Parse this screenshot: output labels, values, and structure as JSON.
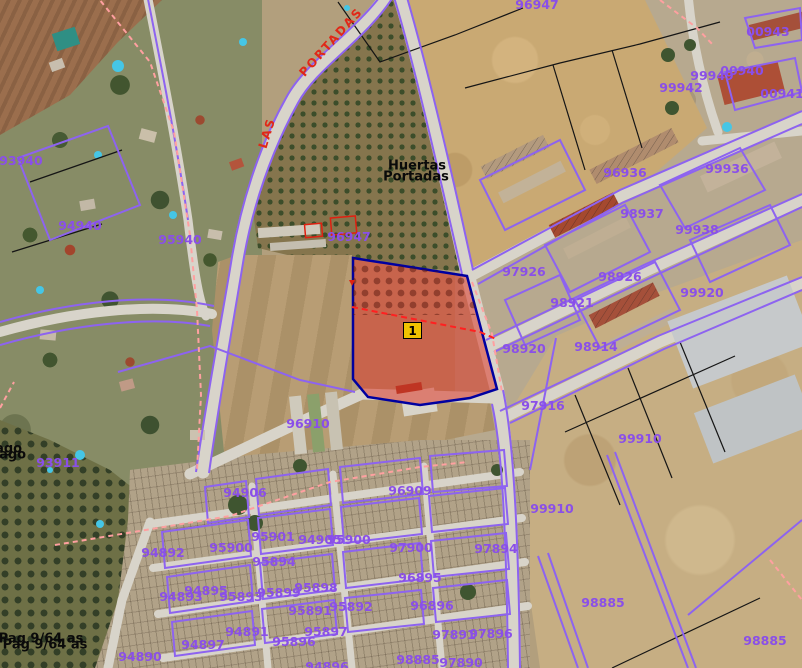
{
  "map": {
    "marker": {
      "label": "1"
    },
    "street_labels": [
      {
        "text": "LAS",
        "x": 267,
        "y": 133,
        "rotation": -73
      },
      {
        "text": "PORTADAS",
        "x": 331,
        "y": 42,
        "rotation": -48
      }
    ],
    "area_labels": [
      {
        "text": "Huertas",
        "x": 417,
        "y": 166,
        "ghost": false
      },
      {
        "text": "Portadas",
        "x": 416,
        "y": 177,
        "ghost": false
      },
      {
        "text": "Pago",
        "x": 4,
        "y": 449,
        "ghost": true
      },
      {
        "text": "Pag 9/64 as",
        "x": 41,
        "y": 639,
        "ghost": true
      }
    ],
    "parcel_labels": [
      {
        "text": "96947",
        "x": 537,
        "y": 5
      },
      {
        "text": "00943",
        "x": 768,
        "y": 32
      },
      {
        "text": "99949",
        "x": 712,
        "y": 76
      },
      {
        "text": "00940",
        "x": 742,
        "y": 71
      },
      {
        "text": "00941",
        "x": 782,
        "y": 94
      },
      {
        "text": "99942",
        "x": 681,
        "y": 88
      },
      {
        "text": "93940",
        "x": 21,
        "y": 161
      },
      {
        "text": "96936",
        "x": 625,
        "y": 173
      },
      {
        "text": "99936",
        "x": 727,
        "y": 169
      },
      {
        "text": "95940",
        "x": 180,
        "y": 240
      },
      {
        "text": "94940",
        "x": 80,
        "y": 226
      },
      {
        "text": "96947",
        "x": 349,
        "y": 237
      },
      {
        "text": "98937",
        "x": 642,
        "y": 214
      },
      {
        "text": "99938",
        "x": 697,
        "y": 230
      },
      {
        "text": "97926",
        "x": 524,
        "y": 272
      },
      {
        "text": "98926",
        "x": 620,
        "y": 277
      },
      {
        "text": "99920",
        "x": 702,
        "y": 293
      },
      {
        "text": "98921",
        "x": 572,
        "y": 303
      },
      {
        "text": "98920",
        "x": 524,
        "y": 349
      },
      {
        "text": "98914",
        "x": 596,
        "y": 347
      },
      {
        "text": "96910",
        "x": 308,
        "y": 424
      },
      {
        "text": "97916",
        "x": 543,
        "y": 406
      },
      {
        "text": "99910",
        "x": 640,
        "y": 439
      },
      {
        "text": "93911",
        "x": 58,
        "y": 463
      },
      {
        "text": "94906",
        "x": 245,
        "y": 493
      },
      {
        "text": "96909",
        "x": 410,
        "y": 491
      },
      {
        "text": "99910",
        "x": 552,
        "y": 509
      },
      {
        "text": "95901",
        "x": 273,
        "y": 537
      },
      {
        "text": "94905",
        "x": 320,
        "y": 540
      },
      {
        "text": "95900",
        "x": 349,
        "y": 540
      },
      {
        "text": "94892",
        "x": 163,
        "y": 553
      },
      {
        "text": "95900",
        "x": 231,
        "y": 548
      },
      {
        "text": "95894",
        "x": 274,
        "y": 562
      },
      {
        "text": "97900",
        "x": 411,
        "y": 548
      },
      {
        "text": "97894",
        "x": 496,
        "y": 549
      },
      {
        "text": "96895",
        "x": 420,
        "y": 578
      },
      {
        "text": "98885",
        "x": 603,
        "y": 603
      },
      {
        "text": "94893",
        "x": 181,
        "y": 597
      },
      {
        "text": "94895",
        "x": 206,
        "y": 591
      },
      {
        "text": "95893",
        "x": 241,
        "y": 597
      },
      {
        "text": "95899",
        "x": 279,
        "y": 593
      },
      {
        "text": "95898",
        "x": 316,
        "y": 588
      },
      {
        "text": "95892",
        "x": 351,
        "y": 607
      },
      {
        "text": "95891",
        "x": 310,
        "y": 611
      },
      {
        "text": "96896",
        "x": 432,
        "y": 606
      },
      {
        "text": "94891",
        "x": 247,
        "y": 632
      },
      {
        "text": "95897",
        "x": 326,
        "y": 632
      },
      {
        "text": "95896",
        "x": 294,
        "y": 642
      },
      {
        "text": "94897",
        "x": 203,
        "y": 645
      },
      {
        "text": "94890",
        "x": 140,
        "y": 657
      },
      {
        "text": "97891",
        "x": 454,
        "y": 635
      },
      {
        "text": "97896",
        "x": 491,
        "y": 634
      },
      {
        "text": "98885",
        "x": 418,
        "y": 660
      },
      {
        "text": "97890",
        "x": 461,
        "y": 663
      },
      {
        "text": "94896",
        "x": 327,
        "y": 667
      },
      {
        "text": "98885",
        "x": 765,
        "y": 641
      }
    ],
    "colors": {
      "parcel_line": "#8d63f0",
      "parcel_label": "#8a4fe8",
      "street_label": "#e02818",
      "highlight_fill": "rgba(221,42,28,0.5)",
      "highlight_border": "#0000a0",
      "marker_fill": "#f0c300"
    }
  }
}
